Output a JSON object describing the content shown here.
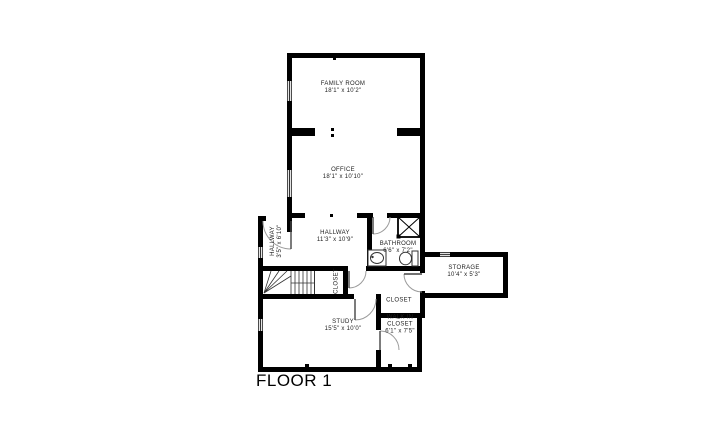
{
  "floor_label": "FLOOR 1",
  "rooms": {
    "family_room": {
      "name": "FAMILY ROOM",
      "dims": "18'1\" x 10'2\""
    },
    "office": {
      "name": "OFFICE",
      "dims": "18'1\" x 10'10\""
    },
    "hallway_main": {
      "name": "HALLWAY",
      "dims": "11'3\" x 10'9\""
    },
    "hallway_small": {
      "name": "HALLWAY",
      "dims": "3'5\" x 6'10\""
    },
    "bathroom": {
      "name": "BATHROOM",
      "dims": "6'6\" x 7'2\""
    },
    "storage": {
      "name": "STORAGE",
      "dims": "10'4\" x 5'3\""
    },
    "closet_hall": {
      "name": "CLOSET"
    },
    "closet_vestibule": {
      "name": "CLOSET"
    },
    "walk_in_closet": {
      "name_line1": "WALK IN",
      "name_line2": "CLOSET",
      "dims": "6'1\" x 7'5\""
    },
    "study": {
      "name": "STUDY",
      "dims": "15'5\" x 10'0\""
    }
  },
  "colors": {
    "wall": "#000000",
    "door_arc": "#9a9a9a",
    "label": "#1d1d1d",
    "background": "#ffffff"
  }
}
